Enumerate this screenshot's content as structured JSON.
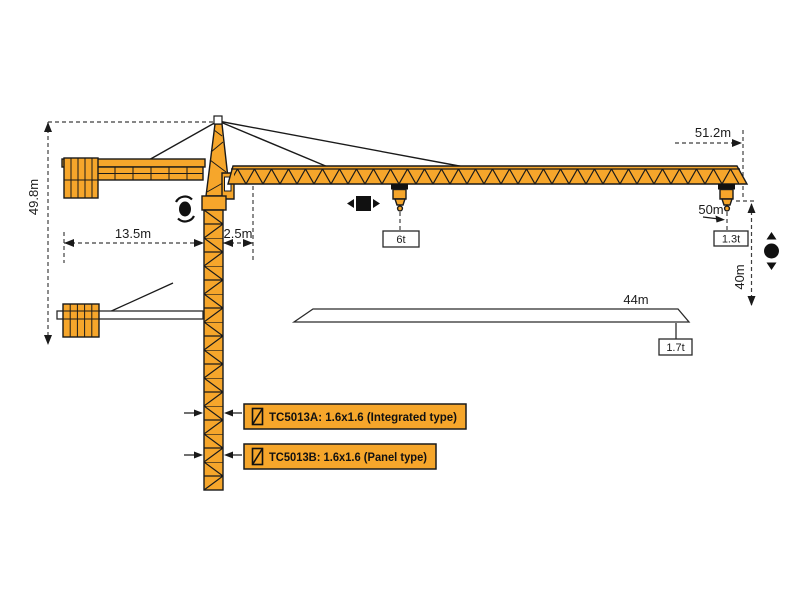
{
  "dimensions": {
    "max_hook_height": "49.8m",
    "counter_jib_length": "13.5m",
    "tower_rear_offset": "2.5m",
    "max_working_radius": "51.2m",
    "trolley_travel_range": "50m",
    "lift_height_at_tip": "40m",
    "mid_radius": "44m"
  },
  "loads": {
    "max_load": "6t",
    "tip_load": "1.3t",
    "load_at_44m": "1.7t"
  },
  "mast_labels": {
    "integrated": "TC5013A:  1.6x1.6 (Integrated type)",
    "panel": "TC5013B:  1.6x1.6 (Panel type)"
  },
  "symbols": {
    "slewing_icon": "rotation-arrows-around-dot",
    "trolley_travel_icon": "square-with-left-right-arrows",
    "hoisting_icon": "dot-with-up-down-arrows",
    "mast_section_icon": "rectangle-with-diagonal"
  },
  "colors": {
    "crane_orange": "#F6A62B",
    "outline_black": "#1a1a1a",
    "dimension_gray": "#3f3f3f",
    "background": "#ffffff"
  }
}
